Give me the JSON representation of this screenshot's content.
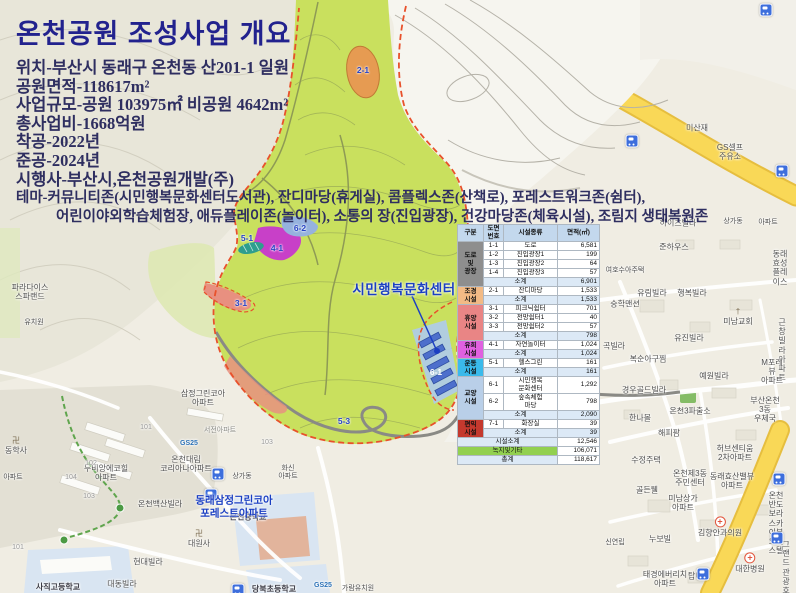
{
  "header": {
    "title": "온천공원 조성사업 개요",
    "lines": [
      "위치-부산시 동래구 온천동 산201-1 일원",
      "공원면적-118617m²",
      "사업규모-공원 103975㎡ 비공원 4642m²",
      "총사업비-1668억원",
      "착공-2022년",
      "준공-2024년",
      "시행사-부산시,온천공원개발(주)"
    ],
    "theme_line1": "테마-커뮤니티존(시민행복문화센터도서관), 잔디마당(휴게실), 콤플렉스존(산책로), 포레스트워크존(쉼터),",
    "theme_line2": "어린이야외학습체험장, 애듀플레이존(놀이터), 소통의 장(진입광장), 건강마당존(체육시설), 조림지 생태복원존"
  },
  "plan": {
    "center_callout": "시민행복문화센터",
    "apartment_callout": "동래삼정그린코아\n포레스트아파트",
    "zone_labels": [
      {
        "t": "2-1",
        "x": 363,
        "y": 70
      },
      {
        "t": "5-1",
        "x": 247,
        "y": 238
      },
      {
        "t": "6-2",
        "x": 300,
        "y": 228
      },
      {
        "t": "4-1",
        "x": 277,
        "y": 248
      },
      {
        "t": "3-1",
        "x": 241,
        "y": 303
      },
      {
        "t": "5-3",
        "x": 344,
        "y": 421
      },
      {
        "t": "6-1",
        "x": 436,
        "y": 372,
        "c": "#FFFFFF"
      }
    ]
  },
  "table": {
    "headers": [
      "구분",
      "도면\n번호",
      "시설종류",
      "면적(㎡)"
    ],
    "rows": [
      {
        "cat": {
          "label": "도로\n및\n광장",
          "span": 5,
          "bg": "#8E8E8E"
        },
        "no": "1-1",
        "name": "도로",
        "area": "6,581"
      },
      {
        "no": "1-2",
        "name": "진입광장1",
        "area": "199"
      },
      {
        "no": "1-3",
        "name": "진입광장2",
        "area": "64"
      },
      {
        "no": "1-4",
        "name": "진입광장3",
        "area": "57"
      },
      {
        "sub": true,
        "name": "소계",
        "area": "6,901"
      },
      {
        "cat": {
          "label": "조경\n시설",
          "span": 2,
          "bg": "#F2BA85"
        },
        "no": "2-1",
        "name": "잔디마당",
        "area": "1,533"
      },
      {
        "sub": true,
        "name": "소계",
        "area": "1,533"
      },
      {
        "cat": {
          "label": "휴양\n시설",
          "span": 4,
          "bg": "#E98585"
        },
        "no": "3-1",
        "name": "피크닉쉼터",
        "area": "701"
      },
      {
        "no": "3-2",
        "name": "전망쉼터1",
        "area": "40"
      },
      {
        "no": "3-3",
        "name": "전망쉼터2",
        "area": "57"
      },
      {
        "sub": true,
        "name": "소계",
        "area": "798"
      },
      {
        "cat": {
          "label": "유희\n시설",
          "span": 2,
          "bg": "#E060E0"
        },
        "no": "4-1",
        "name": "자연놀이터",
        "area": "1,024"
      },
      {
        "sub": true,
        "name": "소계",
        "area": "1,024"
      },
      {
        "cat": {
          "label": "운동\n시설",
          "span": 2,
          "bg": "#3ABAEB"
        },
        "no": "5-1",
        "name": "헬스그린",
        "area": "161"
      },
      {
        "sub": true,
        "name": "소계",
        "area": "161"
      },
      {
        "cat": {
          "label": "교양\n시설",
          "span": 3,
          "bg": "#B9CFE8"
        },
        "no": "6-1",
        "name": "시민행복\n문화센터",
        "area": "1,292"
      },
      {
        "no": "6-2",
        "name": "숲속체험\n마당",
        "area": "798"
      },
      {
        "sub": true,
        "name": "소계",
        "area": "2,090"
      },
      {
        "cat": {
          "label": "편익\n시설",
          "span": 2,
          "bg": "#C4392E"
        },
        "no": "7-1",
        "name": "화장실",
        "area": "39"
      },
      {
        "sub": true,
        "name": "소계",
        "area": "39"
      },
      {
        "summary": "시설소계",
        "bg": "#DCE9F6",
        "area": "12,546"
      },
      {
        "summary": "녹지및기타",
        "bg": "#92D050",
        "area": "106,071"
      },
      {
        "summary": "총계",
        "bg": "#DCE9F6",
        "area": "118,617"
      }
    ]
  },
  "map": {
    "labels": [
      {
        "t": "파라다이스\n스파랜드",
        "x": 30,
        "y": 292
      },
      {
        "t": "유치원",
        "x": 34,
        "y": 323,
        "s": 7
      },
      {
        "t": "동학사",
        "x": 16,
        "y": 446,
        "i": "temple"
      },
      {
        "t": "아파트",
        "x": 13,
        "y": 478,
        "s": 7
      },
      {
        "t": "삼정그린코아\n아파트",
        "x": 203,
        "y": 398
      },
      {
        "t": "서전아파트",
        "x": 220,
        "y": 431,
        "s": 7,
        "c": "#8C8C86"
      },
      {
        "t": "GS25",
        "x": 189,
        "y": 444,
        "s": 7,
        "c": "#2C72B8",
        "b": 1
      },
      {
        "t": "온천대림\n코리아나아파트",
        "x": 186,
        "y": 464
      },
      {
        "t": "상가동",
        "x": 242,
        "y": 477,
        "s": 7
      },
      {
        "t": "화신\n아파트",
        "x": 288,
        "y": 473,
        "s": 7
      },
      {
        "t": "두비앙에코힐\n아파트",
        "x": 106,
        "y": 473
      },
      {
        "t": "101",
        "x": 146,
        "y": 428,
        "s": 7,
        "c": "#999999"
      },
      {
        "t": "102",
        "x": 91,
        "y": 464,
        "s": 7,
        "c": "#999999"
      },
      {
        "t": "104",
        "x": 71,
        "y": 478,
        "s": 7,
        "c": "#999999"
      },
      {
        "t": "103",
        "x": 89,
        "y": 497,
        "s": 7,
        "c": "#999999"
      },
      {
        "t": "103",
        "x": 267,
        "y": 443,
        "s": 7,
        "c": "#999999"
      },
      {
        "t": "101",
        "x": 18,
        "y": 548,
        "s": 7,
        "c": "#999999"
      },
      {
        "t": "온천백산빌라",
        "x": 160,
        "y": 504
      },
      {
        "t": "온천중학교",
        "x": 248,
        "y": 517,
        "b": 1,
        "c": "#3C3C46"
      },
      {
        "t": "대원사",
        "x": 199,
        "y": 539,
        "i": "temple"
      },
      {
        "t": "현대빌라",
        "x": 148,
        "y": 562
      },
      {
        "t": "대동빌라",
        "x": 122,
        "y": 584
      },
      {
        "t": "사직고등학교",
        "x": 58,
        "y": 587,
        "b": 1,
        "c": "#3C3C46"
      },
      {
        "t": "당북초등학교",
        "x": 274,
        "y": 589,
        "b": 1,
        "c": "#3C3C46"
      },
      {
        "t": "GS25",
        "x": 323,
        "y": 586,
        "s": 7,
        "c": "#2C72B8",
        "b": 1
      },
      {
        "t": "가람유치원",
        "x": 358,
        "y": 589,
        "s": 7
      },
      {
        "t": "미산재",
        "x": 697,
        "y": 128
      },
      {
        "t": "GS셀프\n주유소",
        "x": 730,
        "y": 152
      },
      {
        "t": "하이츠빌라",
        "x": 678,
        "y": 223
      },
      {
        "t": "상가동",
        "x": 733,
        "y": 222,
        "s": 7
      },
      {
        "t": "아파트",
        "x": 768,
        "y": 223,
        "s": 7
      },
      {
        "t": "준하우스",
        "x": 674,
        "y": 247
      },
      {
        "t": "여호수아주택",
        "x": 625,
        "y": 271,
        "s": 7
      },
      {
        "t": "동래효성\n플레이스",
        "x": 780,
        "y": 268
      },
      {
        "t": "숭학맨션",
        "x": 625,
        "y": 304
      },
      {
        "t": "유림빌라",
        "x": 652,
        "y": 293
      },
      {
        "t": "행복빌라",
        "x": 692,
        "y": 293
      },
      {
        "t": "미남교회",
        "x": 738,
        "y": 317,
        "i": "church"
      },
      {
        "t": "곡빌라",
        "x": 614,
        "y": 346
      },
      {
        "t": "유진빌라",
        "x": 689,
        "y": 338
      },
      {
        "t": "복순아구찜",
        "x": 648,
        "y": 359
      },
      {
        "t": "근창빌라\n아파트",
        "x": 782,
        "y": 350
      },
      {
        "t": "예원빌라",
        "x": 714,
        "y": 376
      },
      {
        "t": "M포레뷰\n아파트",
        "x": 772,
        "y": 372
      },
      {
        "t": "경우골드빌라",
        "x": 644,
        "y": 390
      },
      {
        "t": "한나몰",
        "x": 640,
        "y": 418
      },
      {
        "t": "온천3파출소",
        "x": 690,
        "y": 411
      },
      {
        "t": "부산온천3동\n우체국",
        "x": 765,
        "y": 410
      },
      {
        "t": "해피팜",
        "x": 669,
        "y": 433
      },
      {
        "t": "수정주택",
        "x": 646,
        "y": 460
      },
      {
        "t": "허브센티움\n2차아파트",
        "x": 735,
        "y": 453
      },
      {
        "t": "온천제3동\n주민센터",
        "x": 690,
        "y": 478
      },
      {
        "t": "동래효산밸뷰\n아파트",
        "x": 732,
        "y": 481
      },
      {
        "t": "골든웰",
        "x": 647,
        "y": 490
      },
      {
        "t": "미남상가\n아파트",
        "x": 683,
        "y": 503
      },
      {
        "t": "김향안과의원",
        "x": 720,
        "y": 527,
        "i": "cross"
      },
      {
        "t": "온천반도보라\n스카이뷰오피스텔",
        "x": 776,
        "y": 523
      },
      {
        "t": "누보빌",
        "x": 660,
        "y": 539
      },
      {
        "t": "신연립",
        "x": 615,
        "y": 543,
        "s": 7
      },
      {
        "t": "대한병원",
        "x": 750,
        "y": 563,
        "i": "cross"
      },
      {
        "t": "그랜드\n관광호텔",
        "x": 786,
        "y": 572
      },
      {
        "t": "태경에버리치\n아파트",
        "x": 665,
        "y": 579
      },
      {
        "t": "탑마트",
        "x": 699,
        "y": 576
      }
    ],
    "bus_stops": [
      [
        632,
        141
      ],
      [
        782,
        171
      ],
      [
        766,
        10
      ],
      [
        218,
        474
      ],
      [
        211,
        495
      ],
      [
        779,
        479
      ],
      [
        777,
        538
      ],
      [
        703,
        574
      ],
      [
        238,
        590
      ]
    ]
  },
  "colors": {
    "park_green": "#C9E05E",
    "boundary_red": "#E8512B",
    "road_yellow": "#F9D857",
    "callout_blue": "#1B3FC2",
    "title_navy": "#22228E"
  }
}
